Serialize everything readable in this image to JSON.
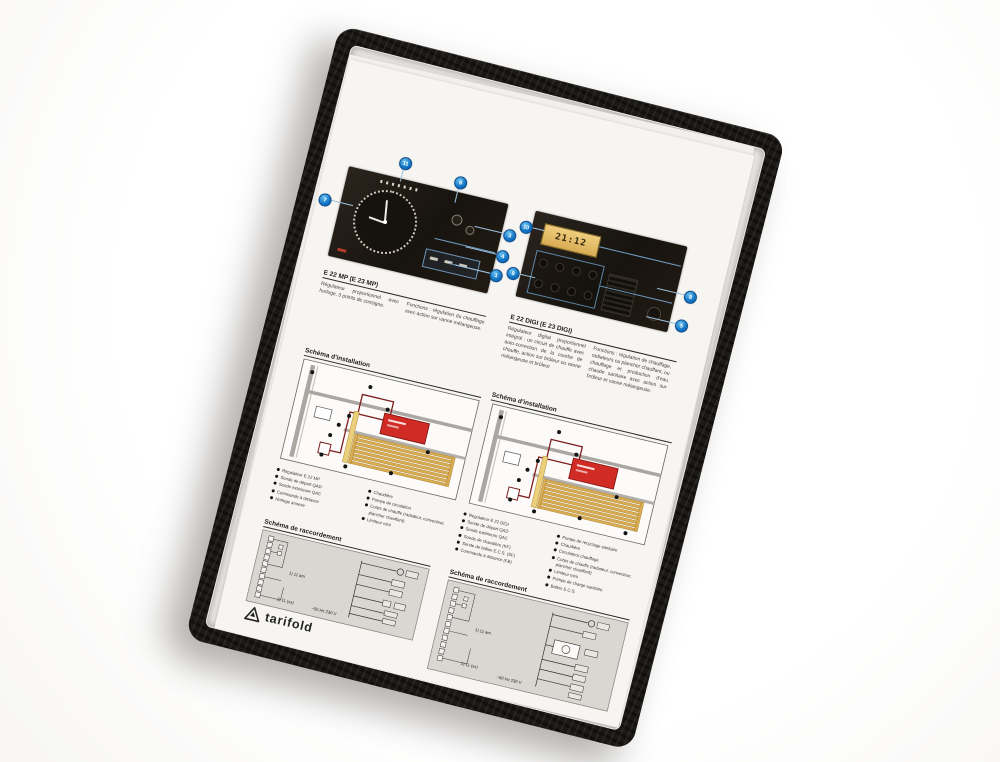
{
  "product": {
    "brand": "tarifold",
    "item": "black display pocket with technical sheet"
  },
  "document": {
    "panel_left": {
      "heading": "E 22 MP (E 23 MP)",
      "col1": "Régulateur proportionnel avec horloge, 3 points de consigne.",
      "col2": "Fonctions : régulation du chauffage avec action sur vanne mélangeuse.",
      "callouts": [
        "7",
        "11",
        "6",
        "3",
        "4",
        "1"
      ]
    },
    "panel_right": {
      "heading": "E 22 DIGI (E 23 DIGI)",
      "col1": "Régulateur digital proportionnel intégral : un circuit de chauffe avec auto-correction de la courbe de chauffe, action sur brûleur ou vanne mélangeuse et brûleur.",
      "col2": "Fonctions : régulation de chauffage, radiateurs ou plancher chauffant, ou chauffage et production d'eau chaude sanitaire avec action sur brûleur et vanne mélangeuse.",
      "callouts": [
        "10",
        "9",
        "8",
        "5"
      ],
      "lcd_value": "21:12"
    },
    "install_left": {
      "title": "Schéma d'installation",
      "legend_a": [
        "Régulateur E 22 MP",
        "Sonde de départ QAD",
        "Sonde extérieure QAC",
        "Commande à distance",
        "Horloge annexe"
      ],
      "legend_b": [
        "Chaudière",
        "Pompe de circulation",
        "Corps de chauffe (radiateur, convecteur, plancher chauffant)",
        "Limiteur mini"
      ]
    },
    "install_right": {
      "title": "Schéma d'installation",
      "legend_a": [
        "Régulateur E 22 DIGI",
        "Sonde de départ QAD",
        "Sonde extérieure QAC",
        "Sonde de chaudière (KF)",
        "Sonde de ballon E.C.S. (SF)",
        "Commande à distance (FB)"
      ],
      "legend_b": [
        "Pompe de recyclage sanitaire",
        "Chaudière",
        "Circulateur chauffage",
        "Corps de chauffe (radiateur, convecteur, plancher chauffant)",
        "Limiteur mini",
        "Pompe de charge sanitaire",
        "Ballon E.C.S."
      ]
    },
    "racc_left": {
      "title": "Schéma de raccordement",
      "note_1": "1) 11 am",
      "note_2": "1) 11 (xx)",
      "power": "~50 Hz 230 V"
    },
    "racc_right": {
      "title": "Schéma de raccordement",
      "note_1": "1) 11 am",
      "note_2": "1) 11 (xx)",
      "power": "~50 Hz 230 V"
    },
    "logo": "tarifold"
  },
  "colors": {
    "frame_black": "#1b1815",
    "paper": "#f7f5f1",
    "callout_blue": "#1173c4",
    "boiler_red": "#d02b24",
    "coil_yellow": "#d9ac52",
    "pipe_dark_red": "#7c1d1d",
    "wiring_gray": "#d9d7d2"
  }
}
